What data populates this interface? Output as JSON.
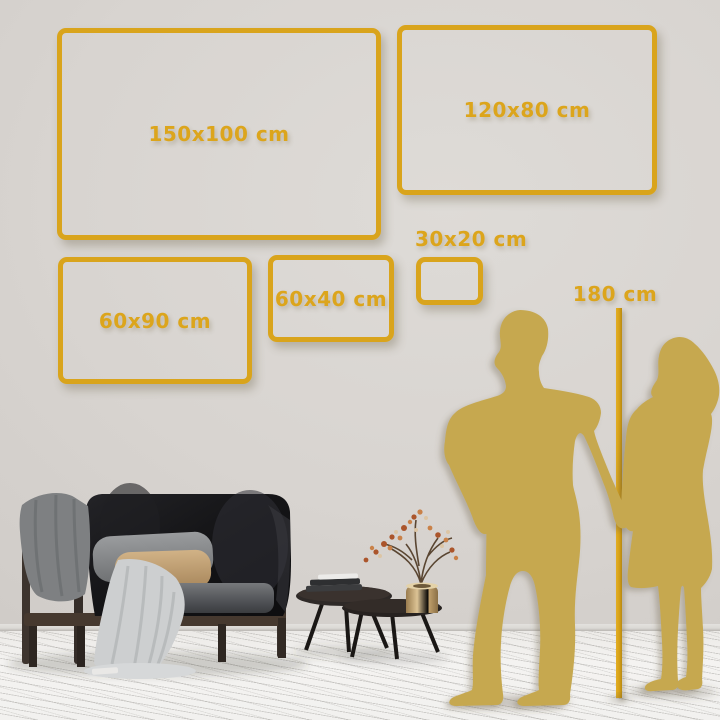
{
  "frames": [
    {
      "label": "150x100 cm"
    },
    {
      "label": "120x80 cm"
    },
    {
      "label": "60x90 cm"
    },
    {
      "label": "60x40 cm"
    },
    {
      "label": "30x20 cm"
    }
  ],
  "height_marker": {
    "label": "180 cm"
  },
  "colors": {
    "accent_gold": "#D9A41C",
    "label_gold": "#DCA51C",
    "silhouette_gold": "#C6A850",
    "wall": "#D6D2CE",
    "floor": "#F2F1EF"
  }
}
